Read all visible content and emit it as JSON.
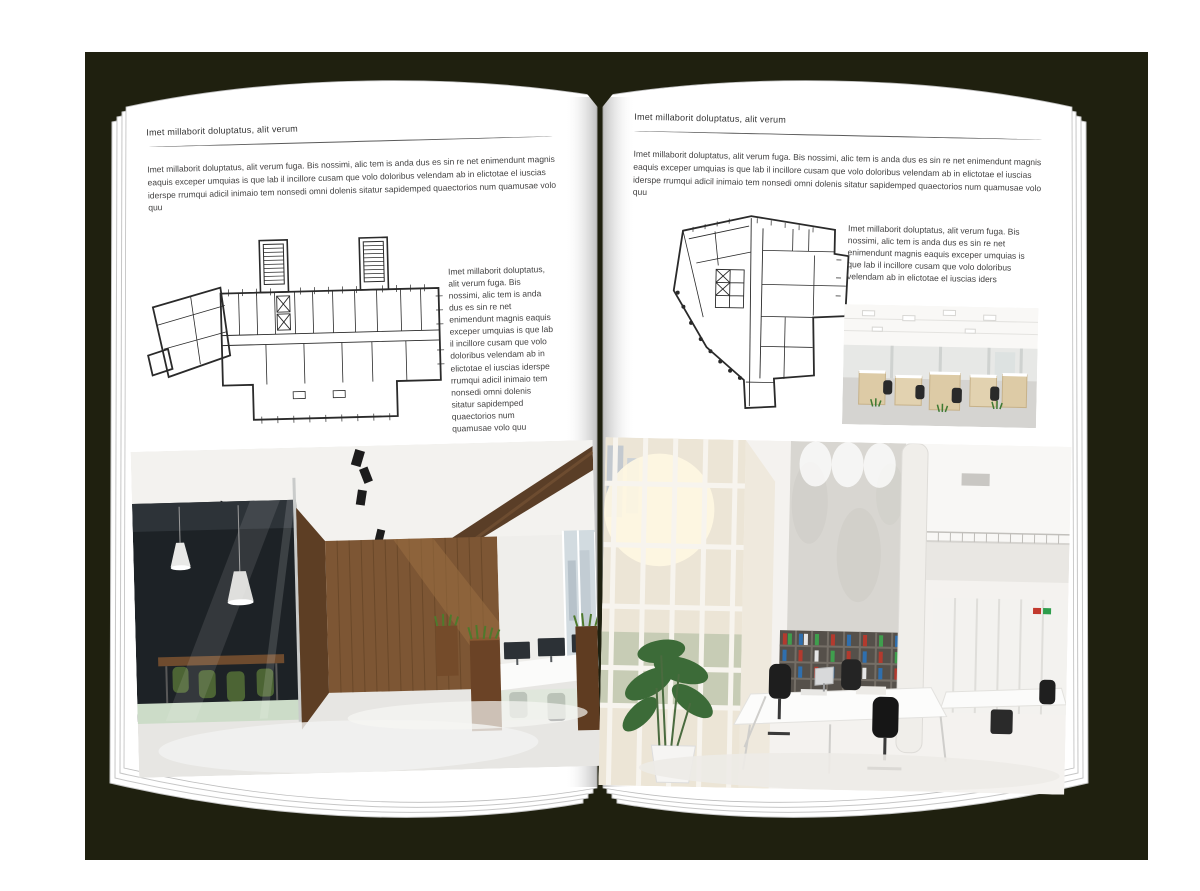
{
  "document": {
    "kind": "magazine-spread-mockup",
    "backdrop_color": "#1f200f",
    "page_color": "#ffffff",
    "text_color": "#434242"
  },
  "left_page": {
    "header": "Imet millaborit doluptatus, alit verum",
    "intro": "Imet millaborit doluptatus, alit verum fuga. Bis nossimi, alic tem is anda dus es sin re net enimendunt magnis eaquis exceper umquias is que lab il incillore cusam que volo doloribus velendam ab in elictotae el iuscias iderspe rrumqui adicil inimaio tem nonsedi omni dolenis sitatur sapidemped quaectorios num quamusae volo quu",
    "side_text": "Imet millaborit doluptatus, alit verum fuga. Bis nossimi, alic tem is anda dus es sin re net enimendunt magnis eaquis exceper umquias is que lab il incillore cusam que volo doloribus velendam ab in elictotae el iuscias iderspe rrumqui adicil inimaio tem nonsedi omni dolenis sitatur sapidemped quaectorios num quamusae volo quu",
    "floor_plan_alt": "architectural floor plan with two stair towers and angled left wing",
    "photo_alt": "modern office interior with dark glass meeting room, green chairs, wooden wall and desks"
  },
  "right_page": {
    "header": "Imet millaborit doluptatus, alit verum",
    "intro": "Imet millaborit doluptatus, alit verum fuga. Bis nossimi, alic tem is anda dus es sin re net enimendunt magnis eaquis exceper umquias is que lab il incillore cusam que volo doloribus velendam ab in elictotae el iuscias iderspe rrumqui adicil inimaio tem nonsedi omni dolenis sitatur sapidemped quaectorios num quamusae volo quu",
    "side_text": "Imet millaborit doluptatus, alit verum fuga. Bis nossimi, alic tem is anda dus es sin re net enimendunt magnis eaquis exceper umquias is que lab il incillore cusam que volo doloribus velendam ab in elictotae el iuscias iders",
    "floor_plan_alt": "irregular architectural floor plan with central core",
    "photo_small_alt": "open plan office with rows of light wood desks and black chairs",
    "photo_alt": "bright double-height office atrium with tall windows, concrete wall, binder shelves and white desks"
  }
}
